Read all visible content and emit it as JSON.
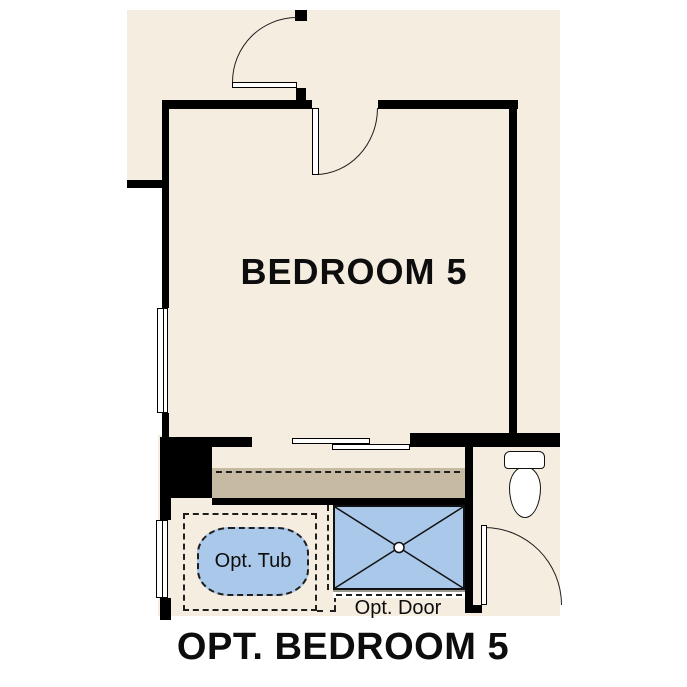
{
  "plan": {
    "room_label": "BEDROOM 5",
    "caption": "OPT. BEDROOM 5",
    "optional_tub_label": "Opt. Tub",
    "optional_door_label": "Opt. Door"
  },
  "colors": {
    "floor": "#f5ede0",
    "counter": "#c7baa2",
    "fixture": "#aac8e9",
    "wall": "#000000",
    "line": "#1f1f1f",
    "background": "#ffffff"
  },
  "fixtures": [
    "window",
    "door-swing",
    "sliding-closet-doors",
    "bathtub",
    "shower",
    "toilet",
    "vanity-counter"
  ]
}
